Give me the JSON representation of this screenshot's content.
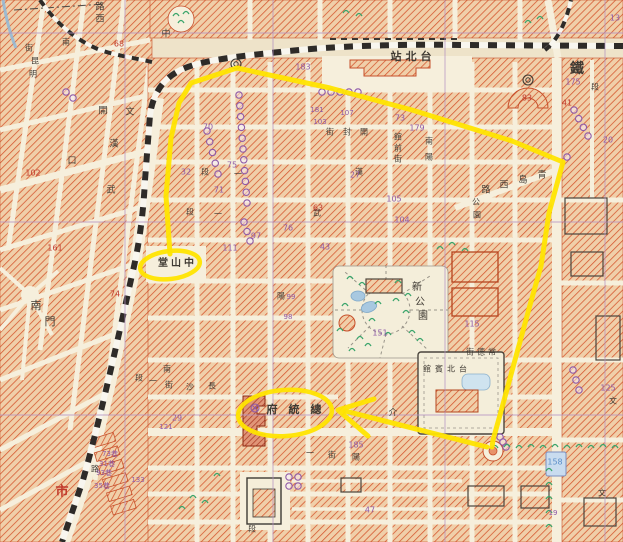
{
  "map": {
    "palette": {
      "background": "#eee3c9",
      "street": "#f6efdc",
      "block_fill": "#f0cfa9",
      "block_hatch": "#d4542c",
      "block_outline": "#c7502b",
      "railway": "#2e2b28",
      "grid": "#b391c2",
      "highlight": "#ffe400",
      "purple": "#8e5aa8",
      "red": "#c0392b",
      "blue": "#5b8fc9",
      "ink": "#3f3a33",
      "water": "#a8c8e0",
      "green": "#3aa56b"
    },
    "labels": [
      {
        "t": "路",
        "x": 100,
        "y": 7,
        "s": 9
      },
      {
        "t": "西",
        "x": 100,
        "y": 19,
        "s": 9
      },
      {
        "t": "中",
        "x": 166,
        "y": 34,
        "s": 9
      },
      {
        "t": "街",
        "x": 29,
        "y": 48,
        "s": 8
      },
      {
        "t": "南",
        "x": 66,
        "y": 42,
        "s": 8
      },
      {
        "t": "昆",
        "x": 35,
        "y": 61,
        "s": 8
      },
      {
        "t": "明",
        "x": 33,
        "y": 74,
        "s": 8
      },
      {
        "t": "開",
        "x": 103,
        "y": 111,
        "s": 9
      },
      {
        "t": "文",
        "x": 130,
        "y": 112,
        "s": 9
      },
      {
        "t": "漢",
        "x": 114,
        "y": 144,
        "s": 9
      },
      {
        "t": "口",
        "x": 72,
        "y": 161,
        "s": 9
      },
      {
        "t": "武",
        "x": 111,
        "y": 190,
        "s": 9
      },
      {
        "t": "站",
        "x": 396,
        "y": 57,
        "s": 11,
        "b": 1
      },
      {
        "t": "北",
        "x": 411,
        "y": 57,
        "s": 11,
        "b": 1
      },
      {
        "t": "台",
        "x": 426,
        "y": 57,
        "s": 11,
        "b": 1
      },
      {
        "t": "鐵",
        "x": 577,
        "y": 69,
        "s": 14,
        "b": 1
      },
      {
        "t": "段",
        "x": 595,
        "y": 87,
        "s": 8
      },
      {
        "t": "街",
        "x": 330,
        "y": 132,
        "s": 8
      },
      {
        "t": "封",
        "x": 347,
        "y": 132,
        "s": 8
      },
      {
        "t": "開",
        "x": 364,
        "y": 132,
        "s": 8
      },
      {
        "t": "館",
        "x": 398,
        "y": 137,
        "s": 8
      },
      {
        "t": "前",
        "x": 398,
        "y": 148,
        "s": 8
      },
      {
        "t": "街",
        "x": 398,
        "y": 159,
        "s": 8
      },
      {
        "t": "南",
        "x": 429,
        "y": 141,
        "s": 8
      },
      {
        "t": "陽",
        "x": 429,
        "y": 157,
        "s": 8
      },
      {
        "t": "漢",
        "x": 359,
        "y": 172,
        "s": 8
      },
      {
        "t": "武",
        "x": 317,
        "y": 213,
        "s": 8
      },
      {
        "t": "路",
        "x": 486,
        "y": 190,
        "s": 9
      },
      {
        "t": "西",
        "x": 504,
        "y": 185,
        "s": 9
      },
      {
        "t": "島",
        "x": 523,
        "y": 180,
        "s": 9
      },
      {
        "t": "青",
        "x": 542,
        "y": 175,
        "s": 9
      },
      {
        "t": "公",
        "x": 476,
        "y": 202,
        "s": 8
      },
      {
        "t": "園",
        "x": 477,
        "y": 215,
        "s": 8
      },
      {
        "t": "新",
        "x": 417,
        "y": 287,
        "s": 10
      },
      {
        "t": "公",
        "x": 420,
        "y": 302,
        "s": 10
      },
      {
        "t": "園",
        "x": 423,
        "y": 316,
        "s": 10
      },
      {
        "t": "館",
        "x": 427,
        "y": 369,
        "s": 8
      },
      {
        "t": "賓",
        "x": 439,
        "y": 369,
        "s": 8
      },
      {
        "t": "北",
        "x": 451,
        "y": 369,
        "s": 8
      },
      {
        "t": "台",
        "x": 463,
        "y": 369,
        "s": 8
      },
      {
        "t": "街",
        "x": 470,
        "y": 352,
        "s": 8
      },
      {
        "t": "德",
        "x": 481,
        "y": 352,
        "s": 8
      },
      {
        "t": "常",
        "x": 492,
        "y": 352,
        "s": 8
      },
      {
        "t": "堂",
        "x": 163,
        "y": 263,
        "s": 10,
        "b": 1
      },
      {
        "t": "山",
        "x": 176,
        "y": 263,
        "s": 10,
        "b": 1
      },
      {
        "t": "中",
        "x": 189,
        "y": 263,
        "s": 10,
        "b": 1
      },
      {
        "t": "府",
        "x": 272,
        "y": 410,
        "s": 11,
        "b": 1
      },
      {
        "t": "統",
        "x": 294,
        "y": 410,
        "s": 11,
        "b": 1
      },
      {
        "t": "總",
        "x": 316,
        "y": 410,
        "s": 11,
        "b": 1
      },
      {
        "t": "段",
        "x": 139,
        "y": 378,
        "s": 8
      },
      {
        "t": "一",
        "x": 153,
        "y": 381,
        "s": 8
      },
      {
        "t": "街",
        "x": 169,
        "y": 385,
        "s": 8
      },
      {
        "t": "沙",
        "x": 190,
        "y": 387,
        "s": 8
      },
      {
        "t": "長",
        "x": 212,
        "y": 386,
        "s": 8
      },
      {
        "t": "南",
        "x": 167,
        "y": 369,
        "s": 8
      },
      {
        "t": "陽",
        "x": 356,
        "y": 457,
        "s": 8
      },
      {
        "t": "街",
        "x": 332,
        "y": 455,
        "s": 8
      },
      {
        "t": "一",
        "x": 310,
        "y": 453,
        "s": 8
      },
      {
        "t": "介",
        "x": 393,
        "y": 413,
        "s": 9
      },
      {
        "t": "南",
        "x": 36,
        "y": 306,
        "s": 11
      },
      {
        "t": "門",
        "x": 50,
        "y": 322,
        "s": 11
      },
      {
        "t": "市",
        "x": 62,
        "y": 492,
        "s": 13,
        "c": "red",
        "b": 1
      },
      {
        "t": "段",
        "x": 205,
        "y": 172,
        "s": 8
      },
      {
        "t": "段",
        "x": 190,
        "y": 212,
        "s": 8
      },
      {
        "t": "一",
        "x": 238,
        "y": 174,
        "s": 8
      },
      {
        "t": "一",
        "x": 218,
        "y": 214,
        "s": 8
      },
      {
        "t": "文",
        "x": 613,
        "y": 401,
        "s": 8
      },
      {
        "t": "文",
        "x": 602,
        "y": 493,
        "s": 8
      },
      {
        "t": "段",
        "x": 252,
        "y": 529,
        "s": 8
      },
      {
        "t": "路",
        "x": 95,
        "y": 469,
        "s": 8
      },
      {
        "t": "陽",
        "x": 281,
        "y": 296,
        "s": 8
      },
      {
        "t": "183",
        "x": 303,
        "y": 67,
        "s": 8,
        "c": "purple"
      },
      {
        "t": "70",
        "x": 208,
        "y": 127,
        "s": 8,
        "c": "purple"
      },
      {
        "t": "32",
        "x": 186,
        "y": 172,
        "s": 8,
        "c": "purple"
      },
      {
        "t": "75",
        "x": 232,
        "y": 165,
        "s": 8,
        "c": "purple"
      },
      {
        "t": "71",
        "x": 219,
        "y": 190,
        "s": 8,
        "c": "purple"
      },
      {
        "t": "97",
        "x": 256,
        "y": 236,
        "s": 8,
        "c": "purple"
      },
      {
        "t": "111",
        "x": 230,
        "y": 248,
        "s": 8,
        "c": "purple"
      },
      {
        "t": "73",
        "x": 400,
        "y": 118,
        "s": 8,
        "c": "purple"
      },
      {
        "t": "179",
        "x": 417,
        "y": 128,
        "s": 8,
        "c": "purple"
      },
      {
        "t": "175",
        "x": 573,
        "y": 82,
        "s": 8,
        "c": "purple"
      },
      {
        "t": "13",
        "x": 615,
        "y": 18,
        "s": 8,
        "c": "purple"
      },
      {
        "t": "20",
        "x": 608,
        "y": 140,
        "s": 8,
        "c": "purple"
      },
      {
        "t": "27",
        "x": 355,
        "y": 175,
        "s": 8,
        "c": "purple"
      },
      {
        "t": "105",
        "x": 394,
        "y": 199,
        "s": 8,
        "c": "purple"
      },
      {
        "t": "104",
        "x": 402,
        "y": 220,
        "s": 8,
        "c": "purple"
      },
      {
        "t": "76",
        "x": 288,
        "y": 228,
        "s": 8,
        "c": "purple"
      },
      {
        "t": "43",
        "x": 325,
        "y": 247,
        "s": 8,
        "c": "purple"
      },
      {
        "t": "151",
        "x": 380,
        "y": 333,
        "s": 8,
        "c": "purple"
      },
      {
        "t": "185",
        "x": 356,
        "y": 445,
        "s": 8,
        "c": "purple"
      },
      {
        "t": "115",
        "x": 472,
        "y": 324,
        "s": 8,
        "c": "purple"
      },
      {
        "t": "125",
        "x": 608,
        "y": 388,
        "s": 8,
        "c": "purple"
      },
      {
        "t": "47",
        "x": 370,
        "y": 510,
        "s": 8,
        "c": "purple"
      },
      {
        "t": "29",
        "x": 177,
        "y": 418,
        "s": 8,
        "c": "purple"
      },
      {
        "t": "181",
        "x": 317,
        "y": 110,
        "s": 7,
        "c": "purple"
      },
      {
        "t": "107",
        "x": 347,
        "y": 113,
        "s": 7,
        "c": "purple"
      },
      {
        "t": "103",
        "x": 320,
        "y": 122,
        "s": 7,
        "c": "purple"
      },
      {
        "t": "99",
        "x": 291,
        "y": 297,
        "s": 7,
        "c": "purple"
      },
      {
        "t": "98",
        "x": 288,
        "y": 317,
        "s": 7,
        "c": "purple"
      },
      {
        "t": "73巷",
        "x": 110,
        "y": 454,
        "s": 7,
        "c": "purple"
      },
      {
        "t": "31巷",
        "x": 107,
        "y": 464,
        "s": 7,
        "c": "purple"
      },
      {
        "t": "93巷",
        "x": 104,
        "y": 473,
        "s": 7,
        "c": "purple"
      },
      {
        "t": "35巷",
        "x": 102,
        "y": 486,
        "s": 7,
        "c": "purple"
      },
      {
        "t": "133",
        "x": 138,
        "y": 480,
        "s": 7,
        "c": "purple"
      },
      {
        "t": "121",
        "x": 166,
        "y": 427,
        "s": 7,
        "c": "purple"
      },
      {
        "t": "158",
        "x": 555,
        "y": 462,
        "s": 8,
        "c": "blue"
      },
      {
        "t": "19",
        "x": 553,
        "y": 513,
        "s": 7,
        "c": "purple"
      },
      {
        "t": "83",
        "x": 527,
        "y": 98,
        "s": 8,
        "c": "red"
      },
      {
        "t": "41",
        "x": 567,
        "y": 103,
        "s": 8,
        "c": "red"
      },
      {
        "t": "74",
        "x": 115,
        "y": 294,
        "s": 8,
        "c": "red"
      },
      {
        "t": "68",
        "x": 119,
        "y": 44,
        "s": 8,
        "c": "red"
      },
      {
        "t": "102",
        "x": 33,
        "y": 173,
        "s": 8,
        "c": "red"
      },
      {
        "t": "161",
        "x": 55,
        "y": 248,
        "s": 8,
        "c": "red"
      },
      {
        "t": "63",
        "x": 318,
        "y": 208,
        "s": 8,
        "c": "red"
      }
    ],
    "stop_chains": [
      {
        "from": [
          239,
          95
        ],
        "to": [
          247,
          203
        ],
        "n": 11
      },
      {
        "from": [
          207,
          131
        ],
        "to": [
          218,
          174
        ],
        "n": 5
      },
      {
        "from": [
          322,
          92
        ],
        "to": [
          358,
          92
        ],
        "n": 5
      },
      {
        "from": [
          574,
          110
        ],
        "to": [
          588,
          136
        ],
        "n": 4
      },
      {
        "from": [
          500,
          437
        ],
        "to": [
          506,
          447
        ],
        "n": 3
      },
      {
        "from": [
          289,
          477
        ],
        "to": [
          289,
          486
        ],
        "n": 2
      },
      {
        "from": [
          298,
          477
        ],
        "to": [
          298,
          486
        ],
        "n": 2
      },
      {
        "from": [
          66,
          92
        ],
        "to": [
          73,
          98
        ],
        "n": 2
      },
      {
        "from": [
          244,
          222
        ],
        "to": [
          250,
          241
        ],
        "n": 3
      },
      {
        "from": [
          573,
          370
        ],
        "to": [
          579,
          390
        ],
        "n": 3
      },
      {
        "from": [
          567,
          157
        ],
        "to": [
          567,
          157
        ],
        "n": 1
      }
    ],
    "special_symbols": [
      {
        "t": "circle-x",
        "x": 255,
        "y": 408
      },
      {
        "t": "double-circle",
        "x": 236,
        "y": 64
      },
      {
        "t": "double-circle",
        "x": 528,
        "y": 80
      }
    ],
    "tree_marks": [
      [
        350,
        278
      ],
      [
        362,
        284
      ],
      [
        396,
        300
      ],
      [
        406,
        312
      ],
      [
        372,
        320
      ],
      [
        388,
        334
      ],
      [
        360,
        338
      ],
      [
        345,
        305
      ],
      [
        412,
        332
      ],
      [
        398,
        282
      ],
      [
        420,
        340
      ],
      [
        352,
        350
      ],
      [
        378,
        303
      ],
      [
        408,
        295
      ],
      [
        368,
        345
      ],
      [
        340,
        330
      ],
      [
        495,
        447
      ],
      [
        507,
        446
      ],
      [
        519,
        447
      ],
      [
        531,
        446
      ],
      [
        543,
        447
      ],
      [
        555,
        446
      ],
      [
        567,
        447
      ],
      [
        579,
        446
      ],
      [
        591,
        447
      ],
      [
        603,
        446
      ],
      [
        615,
        447
      ],
      [
        549,
        470
      ],
      [
        549,
        484
      ],
      [
        549,
        498
      ],
      [
        549,
        512
      ],
      [
        549,
        526
      ],
      [
        176,
        15
      ],
      [
        186,
        13
      ],
      [
        181,
        22
      ],
      [
        346,
        12
      ],
      [
        359,
        15
      ],
      [
        193,
        497
      ],
      [
        205,
        502
      ],
      [
        182,
        508
      ],
      [
        440,
        248
      ],
      [
        452,
        244
      ],
      [
        465,
        250
      ],
      [
        217,
        475
      ],
      [
        528,
        22
      ],
      [
        540,
        18
      ]
    ],
    "highlight": {
      "color": "#ffe400",
      "route": [
        [
          170,
          254
        ],
        [
          166,
          196
        ],
        [
          171,
          138
        ],
        [
          179,
          103
        ],
        [
          191,
          83
        ],
        [
          237,
          68
        ],
        [
          330,
          88
        ],
        [
          412,
          110
        ],
        [
          512,
          141
        ],
        [
          563,
          162
        ],
        [
          549,
          213
        ],
        [
          541,
          266
        ],
        [
          530,
          305
        ],
        [
          512,
          371
        ],
        [
          500,
          415
        ],
        [
          493,
          440
        ],
        [
          492,
          447
        ]
      ],
      "arrow": {
        "shaft": [
          [
            487,
            447
          ],
          [
            345,
            411
          ]
        ],
        "head": [
          [
            374,
            399
          ],
          [
            338,
            410
          ],
          [
            368,
            436
          ]
        ]
      },
      "ellipses": [
        {
          "name": "zhongshan-hall-circle",
          "cx": 170,
          "cy": 265,
          "rx": 30,
          "ry": 14,
          "rot": -7
        },
        {
          "name": "presidential-office-circle",
          "cx": 285,
          "cy": 413,
          "rx": 47,
          "ry": 23,
          "rot": -4
        }
      ]
    }
  }
}
